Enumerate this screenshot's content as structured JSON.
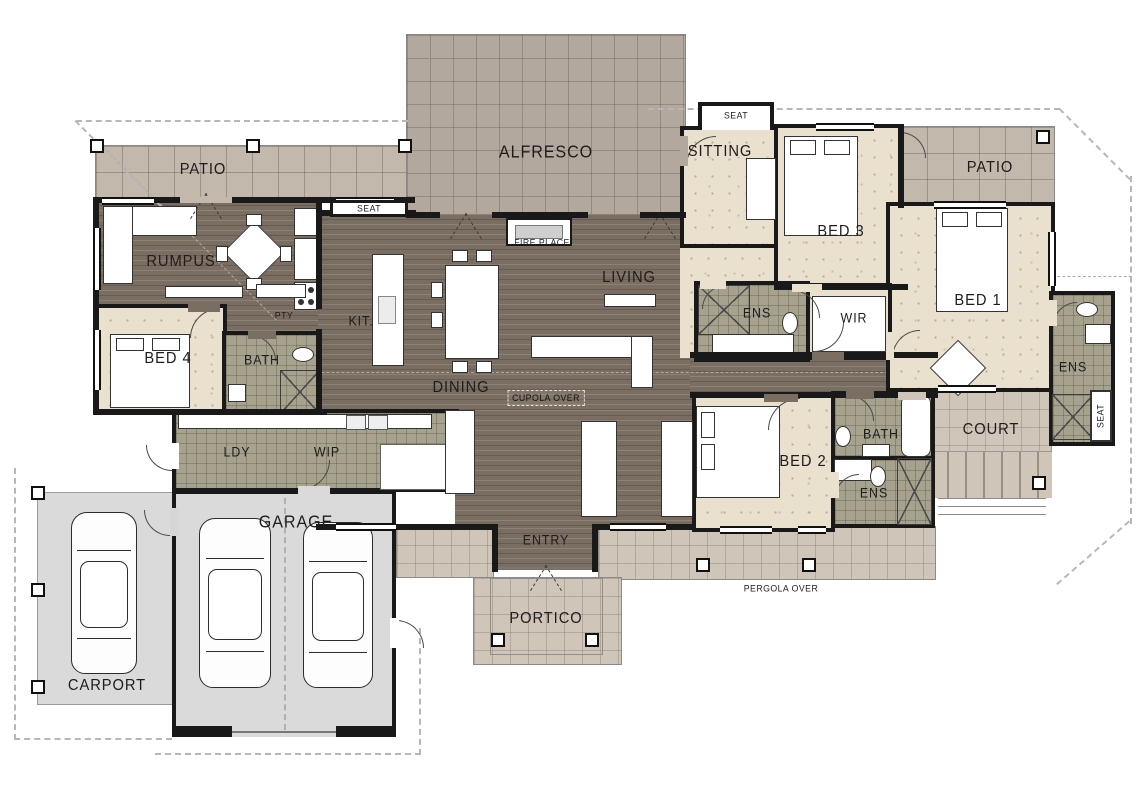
{
  "labels": {
    "patio": "PATIO",
    "alfresco": "ALFRESCO",
    "sitting": "SITTING",
    "seat": "SEAT",
    "bed1": "BED 1",
    "bed2": "BED 2",
    "bed3": "BED 3",
    "bed4": "BED 4",
    "rumpus": "RUMPUS",
    "living": "LIVING",
    "dining": "DINING",
    "kitchen": "KIT.",
    "pantry": "PTY",
    "bath": "BATH",
    "ens": "ENS",
    "wir": "WIR",
    "ldy": "LDY",
    "wip": "WIP",
    "garage": "GARAGE",
    "carport": "CARPORT",
    "entry": "ENTRY",
    "portico": "PORTICO",
    "court": "COURT",
    "fire_place": "FIRE PLACE",
    "cupola_over": "CUPOLA OVER",
    "pergola_over": "PERGOLA OVER"
  },
  "palette": {
    "wall": "#191919",
    "timber_floor": "#7a6e62",
    "bedroom_carpet": "#e9e0ce",
    "wet_area_tile": "#a7a28e",
    "patio_tile": "#c2b8ac",
    "alfresco_tile": "#b2a89d",
    "veranda_tile": "#cfc5b8",
    "garage_slab": "#dadada",
    "paper": "#ffffff"
  }
}
